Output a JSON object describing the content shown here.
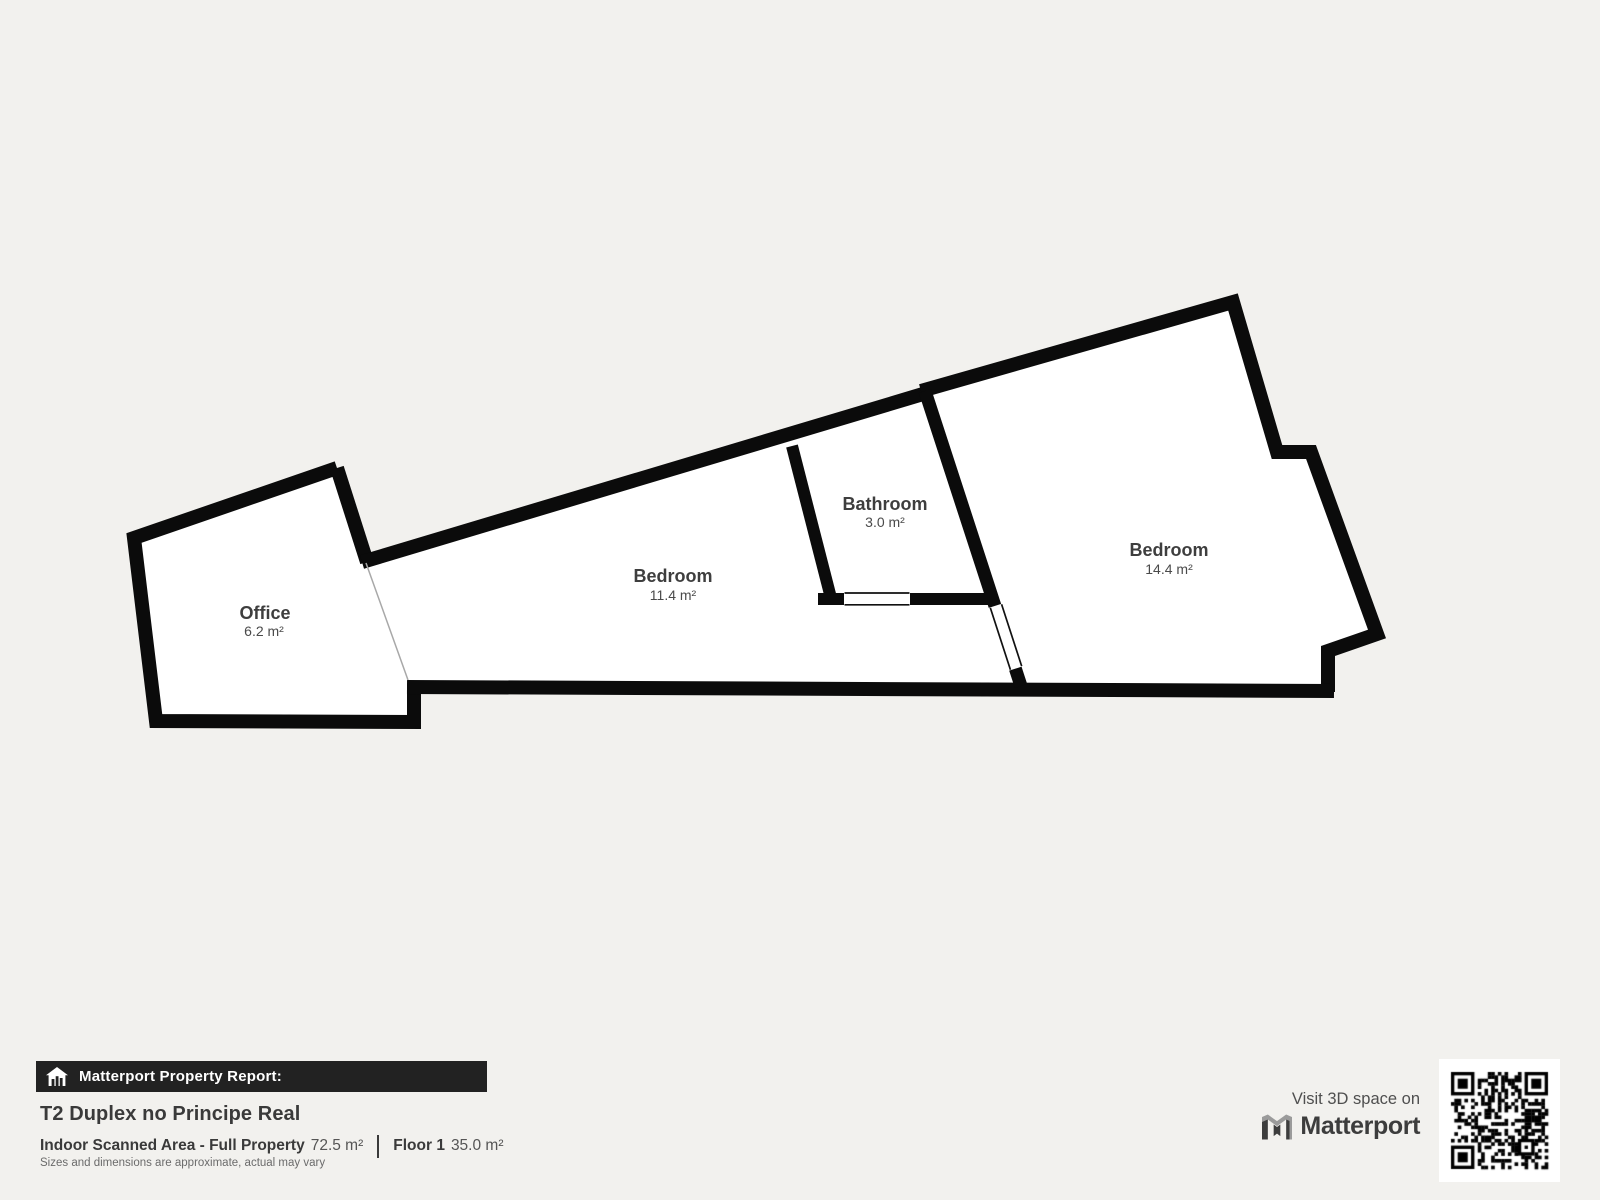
{
  "background": "#f2f1ee",
  "floorplan": {
    "wall_color": "#0b0b0b",
    "room_fill": "#ffffff",
    "label_color": "#3e3e3e",
    "rooms": [
      {
        "name": "Office",
        "area": "6.2 m²"
      },
      {
        "name": "Bedroom",
        "area": "11.4 m²"
      },
      {
        "name": "Bathroom",
        "area": "3.0 m²"
      },
      {
        "name": "Bedroom",
        "area": "14.4 m²"
      }
    ]
  },
  "report": {
    "bar_label": "Matterport Property Report:",
    "title": "T2 Duplex no Principe Real",
    "stats": [
      {
        "label": "Indoor Scanned Area - Full Property",
        "value": "72.5 m²"
      },
      {
        "label": "Floor 1",
        "value": "35.0 m²"
      }
    ],
    "disclaimer": "Sizes and dimensions are approximate, actual may vary"
  },
  "promo": {
    "visit_text": "Visit 3D space on",
    "brand": "Matterport"
  }
}
